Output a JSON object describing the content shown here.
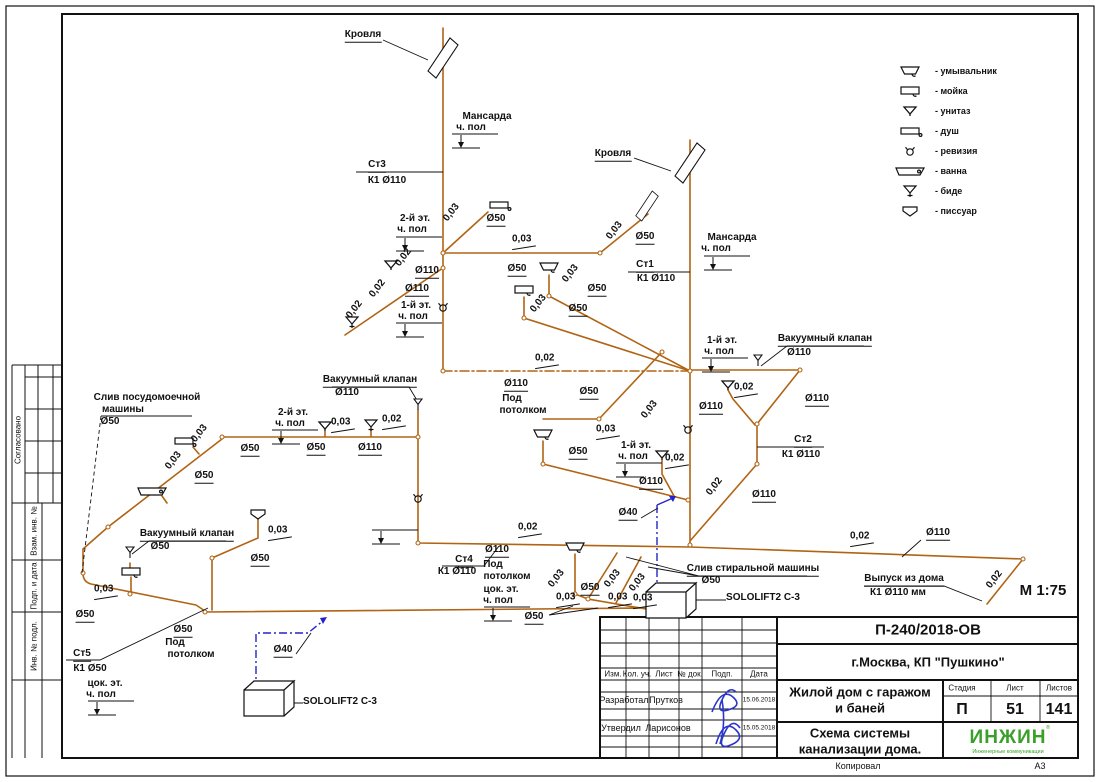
{
  "sheet": {
    "format": "А3",
    "copied_label": "Копировал"
  },
  "legend": {
    "items": [
      {
        "icon": "washbasin-icon",
        "label": "- умывальник"
      },
      {
        "icon": "sink-icon",
        "label": "- мойка"
      },
      {
        "icon": "toilet-icon",
        "label": "- унитаз"
      },
      {
        "icon": "shower-icon",
        "label": "- душ"
      },
      {
        "icon": "revision-icon",
        "label": "- ревизия"
      },
      {
        "icon": "bathtub-icon",
        "label": "- ванна"
      },
      {
        "icon": "bidet-icon",
        "label": "- биде"
      },
      {
        "icon": "urinal-icon",
        "label": "- писсуар"
      }
    ]
  },
  "side_stamp": {
    "soglasovano": "Согласовано",
    "vzam": "Взам. инв. №",
    "podp": "Подп. и дата",
    "inv": "Инв. № подл."
  },
  "title_block": {
    "doc_number": "П-240/2018-ОВ",
    "location": "г.Москва, КП \"Пушкино\"",
    "project_line1": "Жилой дом с гаражом",
    "project_line2": "и баней",
    "title_line1": "Схема системы",
    "title_line2": "канализации дома.",
    "stage_label": "Стадия",
    "stage": "П",
    "sheet_label": "Лист",
    "sheet": "51",
    "sheets_label": "Листов",
    "sheets": "141",
    "logo": "ИНЖИН",
    "logo_reg": "®",
    "logo_sub": "Инженерные коммуникации",
    "header_cols": [
      "Изм.",
      "Кол. уч.",
      "Лист",
      "№ док.",
      "Подп.",
      "Дата"
    ],
    "rows": [
      {
        "role": "Разработал",
        "name": "Прутков",
        "date": "15.06.2018"
      },
      {
        "role": "Утвердил",
        "name": "Ларисонов",
        "date": "15.05.2018"
      }
    ]
  },
  "diagram": {
    "colors": {
      "pipe": "#b06414",
      "pressure_pipe": "#2323cc",
      "leader": "#111111",
      "signature": "#2a35cc",
      "logo_green": "#3aa02a"
    },
    "scale": "М 1:75",
    "labels": [
      {
        "t": "Кровля",
        "x": 363,
        "y": 36,
        "u": 1
      },
      {
        "t": "Мансарда",
        "x": 487,
        "y": 117
      },
      {
        "t": "ч. пол",
        "x": 471,
        "y": 128
      },
      {
        "t": "Ст3",
        "x": 377,
        "y": 166,
        "u": 1
      },
      {
        "t": "К1 Ø110",
        "x": 387,
        "y": 181
      },
      {
        "t": "2-й эт.",
        "x": 415,
        "y": 219
      },
      {
        "t": "ч. пол",
        "x": 412,
        "y": 230
      },
      {
        "t": "0,03",
        "x": 452,
        "y": 213,
        "r": -52
      },
      {
        "t": "Ø50",
        "x": 496,
        "y": 220,
        "u": 1
      },
      {
        "t": "0,02",
        "x": 404,
        "y": 258,
        "r": -52
      },
      {
        "t": "Ø110",
        "x": 427,
        "y": 272,
        "u": 1
      },
      {
        "t": "0,02",
        "x": 378,
        "y": 289,
        "r": -52
      },
      {
        "t": "Ø110",
        "x": 417,
        "y": 290,
        "u": 1
      },
      {
        "t": "0,02",
        "x": 355,
        "y": 310,
        "r": -52
      },
      {
        "t": "1-й эт.",
        "x": 416,
        "y": 306
      },
      {
        "t": "ч. пол",
        "x": 413,
        "y": 317
      },
      {
        "t": "0,03",
        "x": 524,
        "y": 241,
        "s": 1
      },
      {
        "t": "Ø50",
        "x": 517,
        "y": 270,
        "u": 1
      },
      {
        "t": "0,03",
        "x": 571,
        "y": 274,
        "r": -52
      },
      {
        "t": "Ø50",
        "x": 597,
        "y": 290,
        "u": 1
      },
      {
        "t": "0,03",
        "x": 539,
        "y": 304,
        "r": -52
      },
      {
        "t": "Ø50",
        "x": 578,
        "y": 310,
        "u": 1
      },
      {
        "t": "0,03",
        "x": 615,
        "y": 231,
        "r": -52
      },
      {
        "t": "Ø50",
        "x": 645,
        "y": 238,
        "u": 1
      },
      {
        "t": "Кровля",
        "x": 613,
        "y": 155,
        "u": 1
      },
      {
        "t": "Ст1",
        "x": 645,
        "y": 266,
        "u": 1
      },
      {
        "t": "К1 Ø110",
        "x": 656,
        "y": 279
      },
      {
        "t": "Мансарда",
        "x": 732,
        "y": 238
      },
      {
        "t": "ч. пол",
        "x": 716,
        "y": 249
      },
      {
        "t": "1-й эт.",
        "x": 722,
        "y": 341
      },
      {
        "t": "ч. пол",
        "x": 719,
        "y": 352
      },
      {
        "t": "Вакуумный клапан",
        "x": 825,
        "y": 340,
        "u": 1
      },
      {
        "t": "Ø110",
        "x": 799,
        "y": 353
      },
      {
        "t": "0,02",
        "x": 746,
        "y": 389,
        "s": 1
      },
      {
        "t": "Ø110",
        "x": 711,
        "y": 408,
        "u": 1
      },
      {
        "t": "Ø110",
        "x": 817,
        "y": 400,
        "u": 1
      },
      {
        "t": "Ст2",
        "x": 803,
        "y": 441,
        "u": 1
      },
      {
        "t": "К1 Ø110",
        "x": 801,
        "y": 455
      },
      {
        "t": "0,02",
        "x": 715,
        "y": 487,
        "r": -52
      },
      {
        "t": "Ø110",
        "x": 764,
        "y": 496,
        "u": 1
      },
      {
        "t": "0,03",
        "x": 650,
        "y": 410,
        "r": -52
      },
      {
        "t": "Ø50",
        "x": 589,
        "y": 393,
        "u": 1
      },
      {
        "t": "0,03",
        "x": 608,
        "y": 431,
        "s": 1
      },
      {
        "t": "Ø50",
        "x": 578,
        "y": 453,
        "u": 1
      },
      {
        "t": "1-й эт.",
        "x": 636,
        "y": 446
      },
      {
        "t": "ч. пол",
        "x": 633,
        "y": 457
      },
      {
        "t": "0,02",
        "x": 677,
        "y": 460,
        "s": 1
      },
      {
        "t": "Ø110",
        "x": 651,
        "y": 483,
        "u": 1
      },
      {
        "t": "Ø40",
        "x": 628,
        "y": 514,
        "u": 1
      },
      {
        "t": "0,02",
        "x": 547,
        "y": 360,
        "s": 1
      },
      {
        "t": "Ø110",
        "x": 516,
        "y": 385,
        "u": 1
      },
      {
        "t": "Под",
        "x": 512,
        "y": 399
      },
      {
        "t": "потолком",
        "x": 523,
        "y": 411
      },
      {
        "t": "Слив посудомоечной",
        "x": 147,
        "y": 398
      },
      {
        "t": "машины",
        "x": 123,
        "y": 410
      },
      {
        "t": "Ø50",
        "x": 110,
        "y": 422
      },
      {
        "t": "Вакуумный клапан",
        "x": 370,
        "y": 381,
        "u": 1
      },
      {
        "t": "Ø110",
        "x": 347,
        "y": 393
      },
      {
        "t": "2-й эт.",
        "x": 293,
        "y": 413
      },
      {
        "t": "ч. пол",
        "x": 290,
        "y": 424
      },
      {
        "t": "0,03",
        "x": 343,
        "y": 424,
        "s": 1
      },
      {
        "t": "0,02",
        "x": 394,
        "y": 421,
        "s": 1
      },
      {
        "t": "Ø50",
        "x": 250,
        "y": 450,
        "u": 1
      },
      {
        "t": "Ø50",
        "x": 316,
        "y": 449,
        "u": 1
      },
      {
        "t": "Ø110",
        "x": 370,
        "y": 449,
        "u": 1
      },
      {
        "t": "0,03",
        "x": 200,
        "y": 434,
        "r": -52
      },
      {
        "t": "0,03",
        "x": 174,
        "y": 461,
        "r": -52
      },
      {
        "t": "Ø50",
        "x": 204,
        "y": 477,
        "u": 1
      },
      {
        "t": "0,03",
        "x": 280,
        "y": 532,
        "s": 1
      },
      {
        "t": "Ø50",
        "x": 260,
        "y": 560,
        "u": 1
      },
      {
        "t": "Вакуумный клапан",
        "x": 187,
        "y": 535,
        "u": 1
      },
      {
        "t": "Ø50",
        "x": 160,
        "y": 547
      },
      {
        "t": "0,03",
        "x": 106,
        "y": 591,
        "s": 1
      },
      {
        "t": "Ø50",
        "x": 85,
        "y": 616,
        "u": 1
      },
      {
        "t": "Ст5",
        "x": 82,
        "y": 655,
        "u": 1
      },
      {
        "t": "К1 Ø50",
        "x": 90,
        "y": 669
      },
      {
        "t": "цок. эт.",
        "x": 105,
        "y": 684
      },
      {
        "t": "ч. пол",
        "x": 101,
        "y": 695
      },
      {
        "t": "Ø50",
        "x": 183,
        "y": 631,
        "u": 1
      },
      {
        "t": "Под",
        "x": 175,
        "y": 643
      },
      {
        "t": "потолком",
        "x": 191,
        "y": 655
      },
      {
        "t": "Ø40",
        "x": 283,
        "y": 651,
        "u": 1
      },
      {
        "t": "SOLOLIFT2 C-3",
        "x": 340,
        "y": 702
      },
      {
        "t": "0,02",
        "x": 530,
        "y": 529,
        "s": 1
      },
      {
        "t": "Ø110",
        "x": 497,
        "y": 551,
        "u": 1
      },
      {
        "t": "Под",
        "x": 493,
        "y": 565
      },
      {
        "t": "потолком",
        "x": 507,
        "y": 577
      },
      {
        "t": "Ст4",
        "x": 464,
        "y": 561,
        "u": 1
      },
      {
        "t": "К1 Ø110",
        "x": 457,
        "y": 572
      },
      {
        "t": "цок. эт.",
        "x": 501,
        "y": 590
      },
      {
        "t": "ч. пол",
        "x": 498,
        "y": 601
      },
      {
        "t": "0,03",
        "x": 557,
        "y": 579,
        "r": -52
      },
      {
        "t": "0,03",
        "x": 613,
        "y": 579,
        "r": -52
      },
      {
        "t": "0,03",
        "x": 638,
        "y": 583,
        "r": -52
      },
      {
        "t": "0,03",
        "x": 568,
        "y": 599,
        "s": 1
      },
      {
        "t": "0,03",
        "x": 620,
        "y": 599,
        "s": 1
      },
      {
        "t": "0,03",
        "x": 645,
        "y": 600,
        "s": 1
      },
      {
        "t": "Ø50",
        "x": 590,
        "y": 589,
        "u": 1
      },
      {
        "t": "Ø50",
        "x": 534,
        "y": 618,
        "u": 1
      },
      {
        "t": "Слив стиральной машины",
        "x": 753,
        "y": 570,
        "u": 1
      },
      {
        "t": "Ø50",
        "x": 711,
        "y": 581
      },
      {
        "t": "SOLOLIFT2 C-3",
        "x": 763,
        "y": 598
      },
      {
        "t": "0,02",
        "x": 862,
        "y": 538,
        "s": 1
      },
      {
        "t": "Ø110",
        "x": 938,
        "y": 534,
        "u": 1
      },
      {
        "t": "Выпуск из дома",
        "x": 904,
        "y": 580,
        "u": 1
      },
      {
        "t": "К1 Ø110 мм",
        "x": 898,
        "y": 593
      },
      {
        "t": "0,02",
        "x": 995,
        "y": 580,
        "r": -52
      },
      {
        "t": "М 1:75",
        "x": 1043,
        "y": 591,
        "fs": 15
      }
    ]
  }
}
